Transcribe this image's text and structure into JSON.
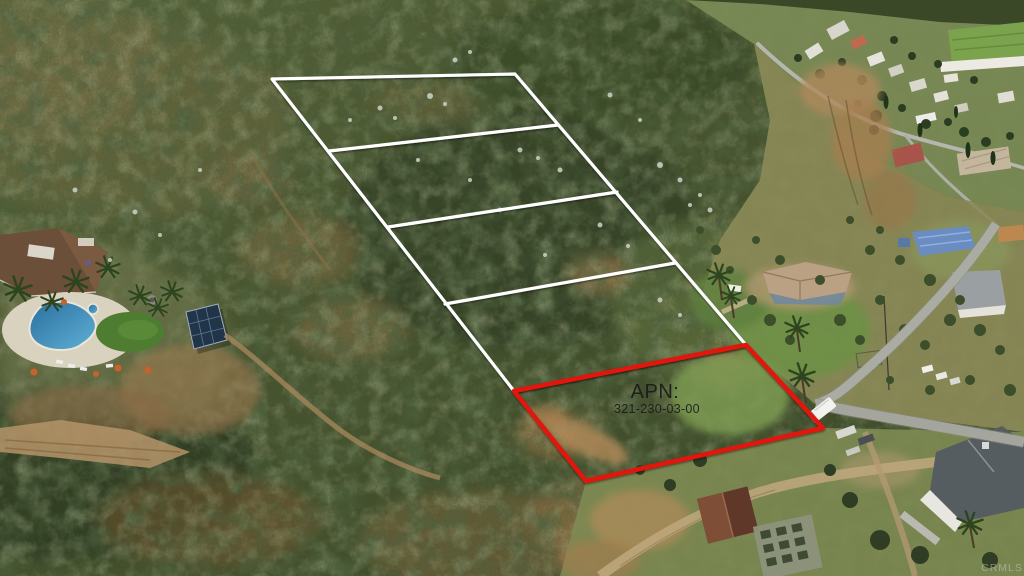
{
  "meta": {
    "description": "Aerial drone photograph of a chaparral hillside showing surveyed vacant land lots outlined in white and a highlighted parcel outlined in red, beside a residential valley neighborhood",
    "image_width": 1024,
    "image_height": 576
  },
  "overlay": {
    "apn_label": "APN:",
    "apn_number": "321-230-03-00"
  },
  "watermark": {
    "text": "CRMLS"
  },
  "colors": {
    "parcel_red": "#e2150c",
    "boundary_white": "#ffffff",
    "apn_text": "#1b1b1b",
    "watermark_gray": "#cfcfcf",
    "pool_blue": "#3c89b4",
    "chaparral_green": "#46532e",
    "dirt_tan": "#a97f4f"
  },
  "parcels": {
    "white_boundary": {
      "outline": "272,79 515,74 746,345 514,391",
      "dividers": [
        "329,151 558,125",
        "388,227 617,192",
        "445,304 675,263"
      ]
    },
    "red_parcel": {
      "outline": "514,391 746,345 823,428 586,481"
    }
  }
}
